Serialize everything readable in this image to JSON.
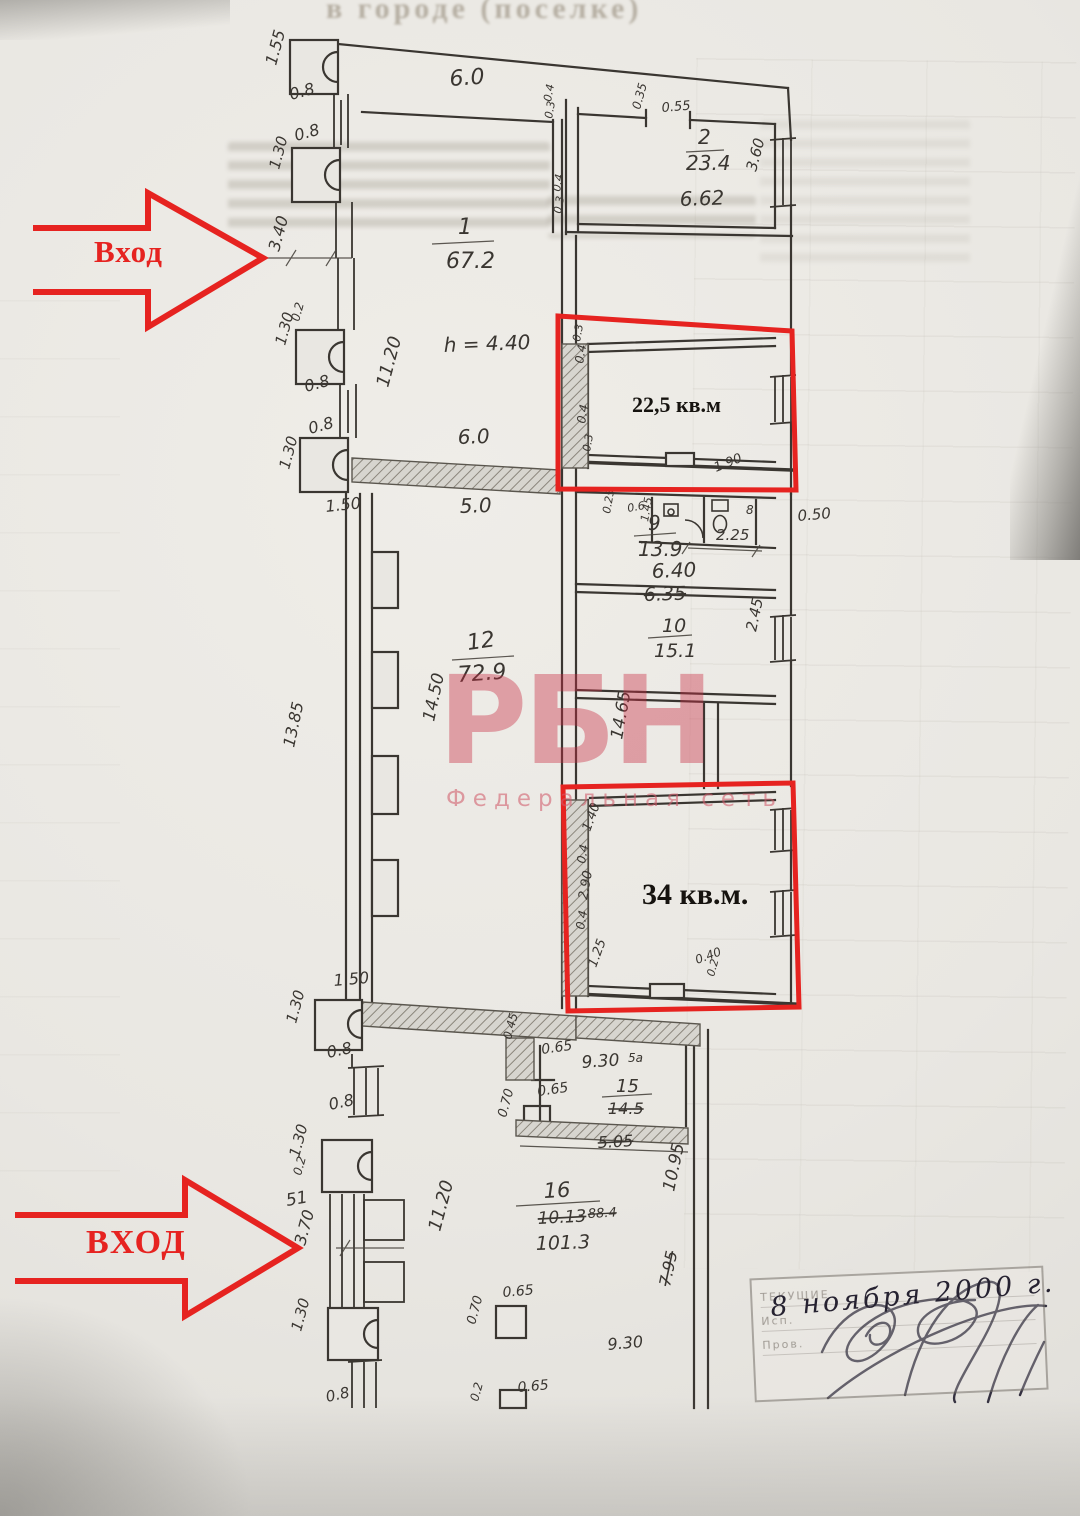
{
  "bleed": {
    "top_line": "в городе (поселке)"
  },
  "annotations": {
    "entrance_top": "Вход",
    "entrance_bottom": "ВХОД",
    "area_top": "22,5 кв.м",
    "area_bottom": "34 кв.м.",
    "red": "#e62320"
  },
  "watermark": {
    "logo": "РБН",
    "subtitle": "Федеральная сеть"
  },
  "stamp": {
    "date": "8 ноября 2000 г.",
    "rows": [
      "ТЕКУЩИЕ",
      "Исп.",
      "Пров."
    ]
  },
  "plan": {
    "ink": "#3a3631",
    "labels": [
      {
        "t": "1.55",
        "x": 276,
        "y": 66,
        "r": -75,
        "fs": 16
      },
      {
        "t": "0.8",
        "x": 291,
        "y": 100,
        "r": -15,
        "fs": 16
      },
      {
        "t": "0.8",
        "x": 296,
        "y": 141,
        "r": -15,
        "fs": 16
      },
      {
        "t": "1.30",
        "x": 279,
        "y": 170,
        "r": -75,
        "fs": 15
      },
      {
        "t": "3.40",
        "x": 279,
        "y": 252,
        "r": -75,
        "fs": 16
      },
      {
        "t": "0.2",
        "x": 299,
        "y": 322,
        "r": -75,
        "fs": 12
      },
      {
        "t": "1.30",
        "x": 285,
        "y": 346,
        "r": -75,
        "fs": 15
      },
      {
        "t": "0.8",
        "x": 306,
        "y": 392,
        "r": -15,
        "fs": 16
      },
      {
        "t": "0.8",
        "x": 310,
        "y": 434,
        "r": -15,
        "fs": 16
      },
      {
        "t": "1.30",
        "x": 289,
        "y": 470,
        "r": -75,
        "fs": 15
      },
      {
        "t": "1.50",
        "x": 326,
        "y": 512,
        "r": -6,
        "fs": 16
      },
      {
        "t": "6.0",
        "x": 450,
        "y": 86,
        "fs": 22,
        "r": -4
      },
      {
        "t": "1",
        "x": 458,
        "y": 234,
        "fs": 22
      },
      {
        "t": "67.2",
        "x": 446,
        "y": 268,
        "fs": 22
      },
      {
        "t": "11.20",
        "x": 388,
        "y": 388,
        "r": -75,
        "fs": 18
      },
      {
        "t": "h = 4.40",
        "x": 444,
        "y": 352,
        "fs": 20,
        "r": -2
      },
      {
        "t": "6.0",
        "x": 458,
        "y": 444,
        "fs": 20,
        "r": -2
      },
      {
        "t": "0.4",
        "x": 551,
        "y": 102,
        "r": -80,
        "fs": 11
      },
      {
        "t": "0.3",
        "x": 552,
        "y": 119,
        "r": -80,
        "fs": 11
      },
      {
        "t": "0.35",
        "x": 640,
        "y": 110,
        "r": -75,
        "fs": 12
      },
      {
        "t": "0.55",
        "x": 662,
        "y": 112,
        "fs": 13,
        "r": -5
      },
      {
        "t": "2",
        "x": 698,
        "y": 144,
        "fs": 20
      },
      {
        "t": "23.4",
        "x": 686,
        "y": 170,
        "fs": 20
      },
      {
        "t": "6.62",
        "x": 680,
        "y": 206,
        "fs": 20,
        "r": -2
      },
      {
        "t": "3.60",
        "x": 756,
        "y": 172,
        "r": -75,
        "fs": 15
      },
      {
        "t": "0.4",
        "x": 560,
        "y": 192,
        "r": -80,
        "fs": 11
      },
      {
        "t": "0.3",
        "x": 561,
        "y": 214,
        "r": -80,
        "fs": 11
      },
      {
        "t": "0.3",
        "x": 580,
        "y": 342,
        "r": -80,
        "fs": 11
      },
      {
        "t": "0.4",
        "x": 583,
        "y": 364,
        "r": -80,
        "fs": 12
      },
      {
        "t": "0.4",
        "x": 585,
        "y": 424,
        "r": -80,
        "fs": 12
      },
      {
        "t": "0.3",
        "x": 590,
        "y": 452,
        "r": -80,
        "fs": 11
      },
      {
        "t": "1.90",
        "x": 716,
        "y": 472,
        "r": -22,
        "fs": 13
      },
      {
        "t": "0.25",
        "x": 610,
        "y": 514,
        "r": -80,
        "fs": 11
      },
      {
        "t": "0.6",
        "x": 628,
        "y": 512,
        "r": -10,
        "fs": 11
      },
      {
        "t": "1.45",
        "x": 648,
        "y": 522,
        "r": -80,
        "fs": 11
      },
      {
        "t": "8",
        "x": 746,
        "y": 514,
        "fs": 12
      },
      {
        "t": "2.25",
        "x": 716,
        "y": 540,
        "fs": 15
      },
      {
        "t": "0.50",
        "x": 798,
        "y": 521,
        "fs": 15,
        "r": -5
      },
      {
        "t": "9",
        "x": 648,
        "y": 530,
        "fs": 20
      },
      {
        "t": "13.9",
        "x": 638,
        "y": 556,
        "fs": 20
      },
      {
        "t": "6.40",
        "x": 652,
        "y": 578,
        "fs": 20,
        "r": -2
      },
      {
        "t": "6.35",
        "x": 644,
        "y": 601,
        "fs": 19,
        "r": -2,
        "strike": true
      },
      {
        "t": "10",
        "x": 662,
        "y": 632,
        "fs": 19
      },
      {
        "t": "15.1",
        "x": 654,
        "y": 657,
        "fs": 19
      },
      {
        "t": "2.45",
        "x": 756,
        "y": 632,
        "r": -78,
        "fs": 15
      },
      {
        "t": "5.0",
        "x": 460,
        "y": 513,
        "fs": 20,
        "r": -2
      },
      {
        "t": "12",
        "x": 468,
        "y": 650,
        "fs": 22,
        "r": -8
      },
      {
        "t": "72.9",
        "x": 458,
        "y": 682,
        "fs": 22,
        "r": -4
      },
      {
        "t": "14.50",
        "x": 434,
        "y": 722,
        "r": -78,
        "fs": 17
      },
      {
        "t": "13.85",
        "x": 294,
        "y": 748,
        "r": -78,
        "fs": 16
      },
      {
        "t": "14.65",
        "x": 622,
        "y": 740,
        "r": -80,
        "fs": 17
      },
      {
        "t": "1.40",
        "x": 590,
        "y": 832,
        "r": -70,
        "fs": 13
      },
      {
        "t": "0.4",
        "x": 585,
        "y": 864,
        "r": -80,
        "fs": 12
      },
      {
        "t": "2.90",
        "x": 587,
        "y": 900,
        "r": -80,
        "fs": 13
      },
      {
        "t": "0.4",
        "x": 584,
        "y": 930,
        "r": -80,
        "fs": 12
      },
      {
        "t": "1.25",
        "x": 596,
        "y": 968,
        "r": -70,
        "fs": 13
      },
      {
        "t": "0.40",
        "x": 697,
        "y": 964,
        "r": -20,
        "fs": 12
      },
      {
        "t": "0.2",
        "x": 714,
        "y": 977,
        "r": -75,
        "fs": 11
      },
      {
        "t": "1.50",
        "x": 334,
        "y": 986,
        "fs": 16,
        "r": -5
      },
      {
        "t": "1.30",
        "x": 296,
        "y": 1024,
        "r": -75,
        "fs": 15
      },
      {
        "t": "0.8",
        "x": 328,
        "y": 1058,
        "r": -12,
        "fs": 16
      },
      {
        "t": "0.8",
        "x": 330,
        "y": 1110,
        "r": -12,
        "fs": 16
      },
      {
        "t": "0.45",
        "x": 511,
        "y": 1040,
        "r": -75,
        "fs": 12
      },
      {
        "t": "0.65",
        "x": 542,
        "y": 1054,
        "fs": 14,
        "r": -8
      },
      {
        "t": "9.30",
        "x": 582,
        "y": 1068,
        "fs": 17,
        "r": -4
      },
      {
        "t": "5а",
        "x": 628,
        "y": 1062,
        "fs": 12,
        "faint": true
      },
      {
        "t": "0.65",
        "x": 538,
        "y": 1096,
        "fs": 14,
        "r": -8
      },
      {
        "t": "0.70",
        "x": 506,
        "y": 1118,
        "r": -75,
        "fs": 13
      },
      {
        "t": "15",
        "x": 616,
        "y": 1092,
        "fs": 18
      },
      {
        "t": "14.5",
        "x": 608,
        "y": 1114,
        "fs": 16,
        "strike": true
      },
      {
        "t": "5.05",
        "x": 598,
        "y": 1148,
        "fs": 16,
        "strike": true,
        "r": -3
      },
      {
        "t": "1.30",
        "x": 299,
        "y": 1158,
        "r": -75,
        "fs": 15
      },
      {
        "t": "0.2",
        "x": 301,
        "y": 1176,
        "r": -75,
        "fs": 12
      },
      {
        "t": "51",
        "x": 287,
        "y": 1206,
        "fs": 17,
        "r": -10
      },
      {
        "t": "3.70",
        "x": 305,
        "y": 1246,
        "r": -75,
        "fs": 16
      },
      {
        "t": "1.30",
        "x": 301,
        "y": 1332,
        "r": -75,
        "fs": 15
      },
      {
        "t": "0.8",
        "x": 327,
        "y": 1402,
        "r": -12,
        "fs": 15
      },
      {
        "t": "16",
        "x": 544,
        "y": 1198,
        "fs": 21,
        "r": -3
      },
      {
        "t": "10.13",
        "x": 538,
        "y": 1224,
        "fs": 17,
        "strike": true,
        "r": -3
      },
      {
        "t": "88.4",
        "x": 588,
        "y": 1218,
        "fs": 13,
        "strike": true,
        "faint": true,
        "r": -3
      },
      {
        "t": "101.3",
        "x": 536,
        "y": 1250,
        "fs": 19,
        "r": -2
      },
      {
        "t": "11.20",
        "x": 440,
        "y": 1232,
        "r": -75,
        "fs": 18
      },
      {
        "t": "10.95",
        "x": 674,
        "y": 1192,
        "r": -78,
        "fs": 17
      },
      {
        "t": "7.95",
        "x": 670,
        "y": 1287,
        "r": -78,
        "fs": 16,
        "strike": true
      },
      {
        "t": "0.65",
        "x": 503,
        "y": 1297,
        "fs": 14,
        "r": -5
      },
      {
        "t": "0.70",
        "x": 475,
        "y": 1325,
        "r": -75,
        "fs": 13
      },
      {
        "t": "9.30",
        "x": 608,
        "y": 1350,
        "fs": 16,
        "r": -5,
        "faint": true
      },
      {
        "t": "0.65",
        "x": 518,
        "y": 1392,
        "fs": 14,
        "r": -5
      },
      {
        "t": "0.2",
        "x": 478,
        "y": 1402,
        "r": -75,
        "fs": 12
      }
    ]
  }
}
